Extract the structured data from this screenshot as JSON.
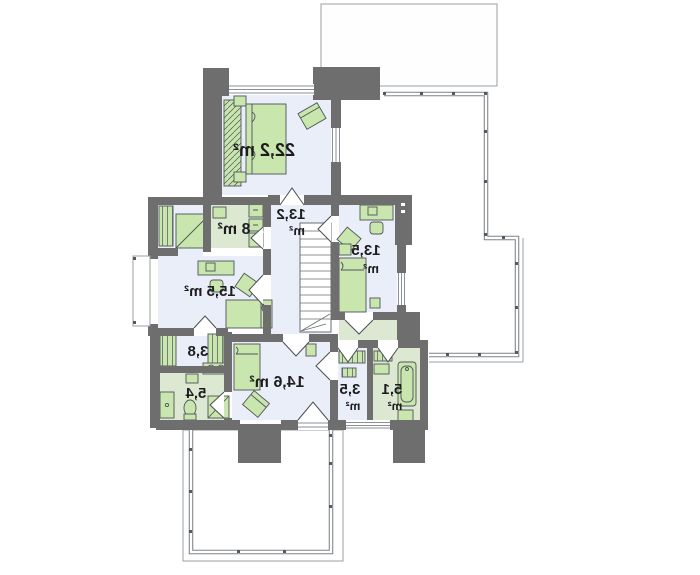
{
  "floor_plan": {
    "colors": {
      "wall": "#6e6e6e",
      "floor": "#e9eef8",
      "wet_floor": "#dce8d2",
      "furniture": "#c9e6ae",
      "furniture_outline": "#4f5459",
      "thin_outline": "#9aa0a6",
      "railing": "#7d8287",
      "window_line": "#8a9096",
      "label_text": "#1d1d1f"
    },
    "text_mirrored": true,
    "rooms": [
      {
        "id": "bedroom-main",
        "line1": "22,2 m²",
        "line2": ""
      },
      {
        "id": "bathroom-top",
        "line1": "8 m²",
        "line2": ""
      },
      {
        "id": "hall-landing",
        "line1": "13,2",
        "line2": "m²"
      },
      {
        "id": "bedroom-right",
        "line1": "13,5",
        "line2": "m²"
      },
      {
        "id": "bedroom-left",
        "line1": "15,5 m²",
        "line2": ""
      },
      {
        "id": "wardrobe",
        "line1": "3,8",
        "line2": ""
      },
      {
        "id": "bathroom-left",
        "line1": "5,4",
        "line2": ""
      },
      {
        "id": "bedroom-bottom",
        "line1": "14,6 m²",
        "line2": ""
      },
      {
        "id": "laundry",
        "line1": "3,5",
        "line2": "m²"
      },
      {
        "id": "bathroom-right",
        "line1": "5,1",
        "line2": "m²"
      }
    ]
  }
}
